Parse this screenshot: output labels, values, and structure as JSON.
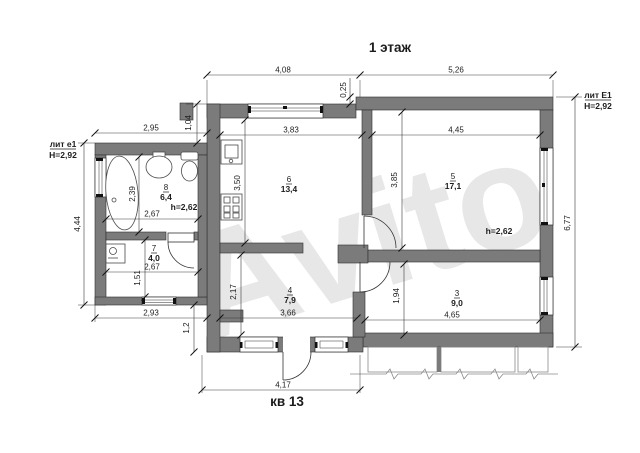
{
  "title": "1 этаж",
  "apartment_label": "кв 13",
  "watermark": "Avito",
  "wing_left": {
    "liter": "лит е1",
    "height": "Н=2,92"
  },
  "wing_right": {
    "liter": "лит Е1",
    "height": "Н=2,92"
  },
  "rooms": {
    "r8": {
      "number": "8",
      "area": "6,4",
      "ceiling": "h=2,62"
    },
    "r7": {
      "number": "7",
      "area": "4,0"
    },
    "r6": {
      "number": "6",
      "area": "13,4"
    },
    "r5": {
      "number": "5",
      "area": "17,1",
      "ceiling": "h=2,62"
    },
    "r4": {
      "number": "4",
      "area": "7,9"
    },
    "r3": {
      "number": "3",
      "area": "9,0"
    }
  },
  "dimensions": {
    "top_left": "4,08",
    "top_right": "5,26",
    "top_step": "0,25",
    "top_inset": "1,04",
    "annex_width": "2,95",
    "kitchen_width": "3,83",
    "room5_width": "4,45",
    "left_height": "4,44",
    "bath_height": "2,39",
    "kitchen_height": "3,50",
    "room5_height": "3,85",
    "bath_width": "2,67",
    "room7_width": "2,67",
    "room7_height": "1,51",
    "annex_bottom": "2,93",
    "step_height": "1,2",
    "hall_height": "2,17",
    "hall_width": "3,66",
    "room3_height": "1,94",
    "room3_width": "4,65",
    "entry_width": "4,17",
    "right_height": "6,77"
  },
  "colors": {
    "wall": "#7b7b7b",
    "line": "#2e2e2e",
    "watermark": "#e7e7e7"
  }
}
